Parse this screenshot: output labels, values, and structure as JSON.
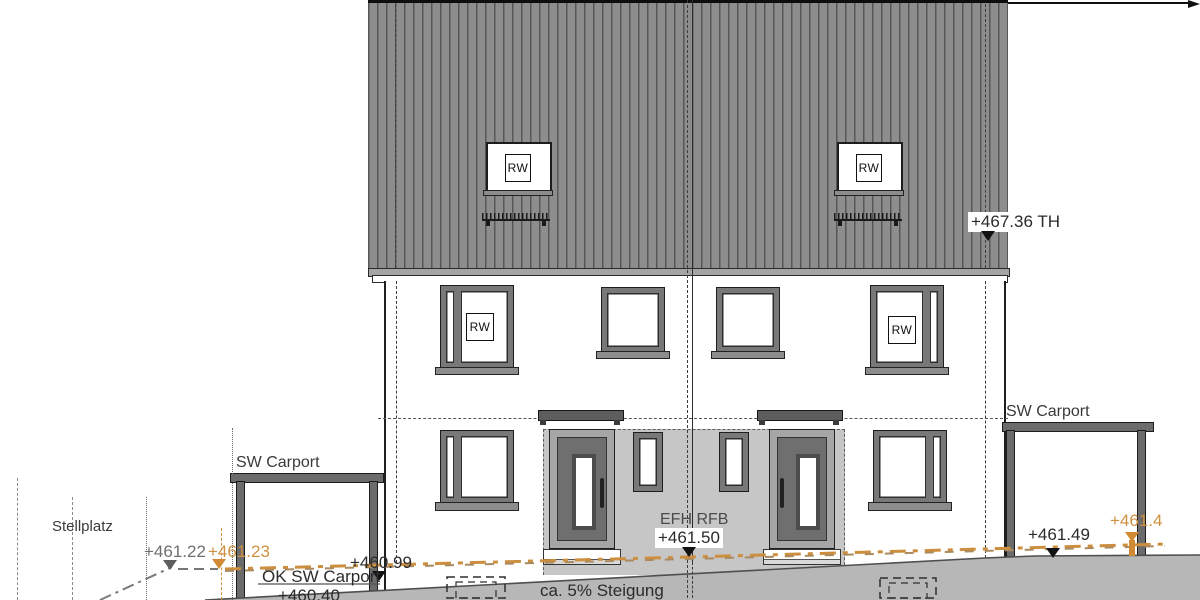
{
  "tags": {
    "rw": "RW"
  },
  "labels": {
    "stellplatz": "Stellplatz",
    "carport_left": "SW Carport",
    "carport_right": "SW Carport",
    "ok_carport": "OK SW Carport",
    "slope": "ca. 5% Steigung",
    "unit": "EFH RFB"
  },
  "levels": {
    "ridge_th": "+467.36 TH",
    "ffl": "+461.50",
    "terrain_existing_left": "+461.22",
    "terrain_planned_left": "+461.23",
    "entry_left": "+460.99",
    "carport_floor": "+460.40",
    "terrain_right": "+461.49",
    "terrain_planned_right": "+461.4"
  },
  "colors": {
    "roof_panel": "#8d8d8d",
    "roof_seam": "#575757",
    "recess": "#c6c6c6",
    "terrain": "#b7b7b7",
    "orange_accent": "#cf9140",
    "door": "#6f6f6f",
    "carport": "#6b6b6b"
  }
}
